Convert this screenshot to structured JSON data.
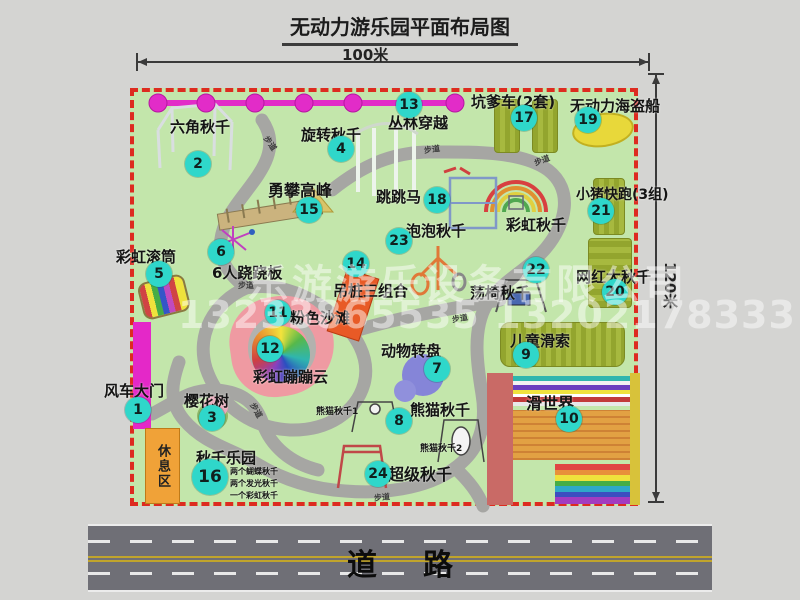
{
  "title": "无动力游乐园平面布局图",
  "dimensions": {
    "top": "100米",
    "right": "120米"
  },
  "road": {
    "label": "道路"
  },
  "watermark": {
    "company": "乐游游乐设备有限公司",
    "phone": "13233865535 13202178333"
  },
  "rest_area": "休息区",
  "attractions": [
    {
      "num": "1",
      "label": "风车大门",
      "cx": 138,
      "cy": 410,
      "lx": 104,
      "ly": 380,
      "fs": 15
    },
    {
      "num": "2",
      "label": "六角秋千",
      "cx": 198,
      "cy": 164,
      "lx": 170,
      "ly": 116,
      "fs": 15
    },
    {
      "num": "3",
      "label": "樱花树",
      "cx": 212,
      "cy": 418,
      "lx": 184,
      "ly": 390,
      "fs": 15
    },
    {
      "num": "4",
      "label": "旋转秋千",
      "cx": 341,
      "cy": 149,
      "lx": 301,
      "ly": 124,
      "fs": 15
    },
    {
      "num": "5",
      "label": "彩虹滚筒",
      "cx": 159,
      "cy": 274,
      "lx": 116,
      "ly": 246,
      "fs": 15
    },
    {
      "num": "6",
      "label": "6人跷跷板",
      "cx": 221,
      "cy": 252,
      "lx": 212,
      "ly": 262,
      "fs": 15
    },
    {
      "num": "7",
      "label": "动物转盘",
      "cx": 437,
      "cy": 369,
      "lx": 381,
      "ly": 340,
      "fs": 15
    },
    {
      "num": "8",
      "label": "熊猫秋千",
      "cx": 399,
      "cy": 421,
      "lx": 410,
      "ly": 399,
      "fs": 15
    },
    {
      "num": "9",
      "label": "儿童滑索",
      "cx": 526,
      "cy": 355,
      "lx": 510,
      "ly": 330,
      "fs": 15
    },
    {
      "num": "10",
      "label": "滑世界",
      "cx": 569,
      "cy": 419,
      "lx": 526,
      "ly": 390,
      "fs": 16
    },
    {
      "num": "11",
      "label": "粉色沙滩",
      "cx": 278,
      "cy": 313,
      "lx": 290,
      "ly": 307,
      "fs": 15
    },
    {
      "num": "12",
      "label": "彩虹蹦蹦云",
      "cx": 270,
      "cy": 349,
      "lx": 253,
      "ly": 366,
      "fs": 15
    },
    {
      "num": "13",
      "label": "丛林穿越",
      "cx": 409,
      "cy": 105,
      "lx": 388,
      "ly": 112,
      "fs": 15
    },
    {
      "num": "14",
      "label": "吊桩三组合",
      "cx": 356,
      "cy": 264,
      "lx": 333,
      "ly": 280,
      "fs": 15
    },
    {
      "num": "15",
      "label": "勇攀高峰",
      "cx": 309,
      "cy": 210,
      "lx": 268,
      "ly": 177,
      "fs": 16
    },
    {
      "num": "16",
      "label": "秋千乐园",
      "cx": 210,
      "cy": 477,
      "lx": 196,
      "ly": 447,
      "fs": 15,
      "d": 36
    },
    {
      "num": "17",
      "label": "坑爹车(2套)",
      "cx": 524,
      "cy": 118,
      "lx": 471,
      "ly": 91,
      "fs": 15
    },
    {
      "num": "18",
      "label": "跳跳马",
      "cx": 437,
      "cy": 200,
      "lx": 376,
      "ly": 186,
      "fs": 15
    },
    {
      "num": "19",
      "label": "无动力海盗船",
      "cx": 588,
      "cy": 120,
      "lx": 570,
      "ly": 95,
      "fs": 15
    },
    {
      "num": "20",
      "label": "网红大秋千",
      "cx": 615,
      "cy": 292,
      "lx": 576,
      "ly": 266,
      "fs": 15
    },
    {
      "num": "21",
      "label": "小猪快跑(3组)",
      "cx": 601,
      "cy": 211,
      "lx": 576,
      "ly": 184,
      "fs": 14
    },
    {
      "num": "22",
      "label": "荡椅秋千",
      "cx": 536,
      "cy": 270,
      "lx": 470,
      "ly": 282,
      "fs": 15
    },
    {
      "num": "23",
      "label": "泡泡秋千",
      "cx": 399,
      "cy": 241,
      "lx": 406,
      "ly": 220,
      "fs": 15
    },
    {
      "num": "24",
      "label": "超级秋千",
      "cx": 378,
      "cy": 474,
      "lx": 388,
      "ly": 461,
      "fs": 16
    }
  ],
  "extra_labels": [
    {
      "text": "彩虹秋千",
      "x": 506,
      "y": 214,
      "fs": 15
    },
    {
      "text": "熊猫秋千1",
      "x": 316,
      "y": 404,
      "fs": 9
    },
    {
      "text": "熊猫秋千2",
      "x": 420,
      "y": 441,
      "fs": 9
    },
    {
      "text": "两个蝴蝶秋千",
      "x": 230,
      "y": 466,
      "fs": 8
    },
    {
      "text": "两个发光秋千",
      "x": 230,
      "y": 478,
      "fs": 8
    },
    {
      "text": "一个彩虹秋千",
      "x": 230,
      "y": 490,
      "fs": 8
    }
  ],
  "path_labels": [
    {
      "text": "步道",
      "x": 262,
      "y": 138,
      "r": 55
    },
    {
      "text": "步道",
      "x": 424,
      "y": 144,
      "r": -8
    },
    {
      "text": "步道",
      "x": 534,
      "y": 155,
      "r": -20
    },
    {
      "text": "步道",
      "x": 238,
      "y": 280,
      "r": 0
    },
    {
      "text": "步道",
      "x": 452,
      "y": 313,
      "r": -10
    },
    {
      "text": "步道",
      "x": 248,
      "y": 405,
      "r": 60
    },
    {
      "text": "步道",
      "x": 374,
      "y": 492,
      "r": -6
    }
  ]
}
